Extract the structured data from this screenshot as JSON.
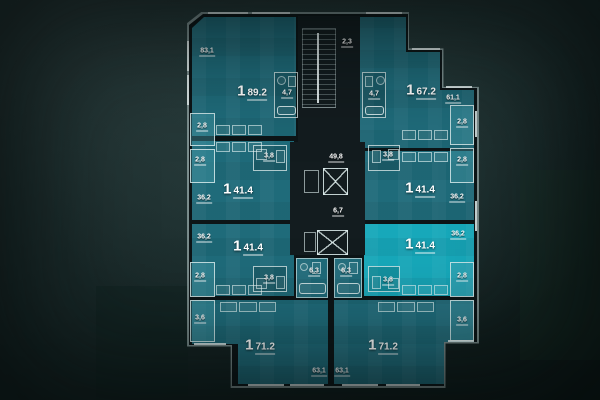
{
  "plan": {
    "apartments": [
      {
        "pos": "top-left",
        "rooms": "1",
        "area": "89.2",
        "living_area": "83,1",
        "bath_area": "4,7",
        "balcony_area": "2,8",
        "highlighted": false
      },
      {
        "pos": "top-right",
        "rooms": "1",
        "area": "67.2",
        "living_area": "61,1",
        "bath_area": "4,7",
        "balcony_area": "2,8",
        "highlighted": false
      },
      {
        "pos": "middle-upper-left",
        "rooms": "1",
        "area": "41.4",
        "living_area": "36,2",
        "bath_area": "3,8",
        "balcony_area": "2,8",
        "highlighted": false
      },
      {
        "pos": "middle-upper-right",
        "rooms": "1",
        "area": "41.4",
        "living_area": "36,2",
        "bath_area": "3,8",
        "balcony_area": "2,8",
        "highlighted": false
      },
      {
        "pos": "middle-lower-left",
        "rooms": "1",
        "area": "41.4",
        "living_area": "36,2",
        "bath_area": "3,8",
        "balcony_area": "2,8",
        "highlighted": false
      },
      {
        "pos": "middle-lower-right",
        "rooms": "1",
        "area": "41.4",
        "living_area": "36,2",
        "bath_area": "3,8",
        "balcony_area": "2,8",
        "highlighted": true
      },
      {
        "pos": "bottom-left",
        "rooms": "1",
        "area": "71.2",
        "living_area": "63,1",
        "bath_area": "6,3",
        "balcony_area": "3,6",
        "highlighted": false
      },
      {
        "pos": "bottom-right",
        "rooms": "1",
        "area": "71.2",
        "living_area": "63,1",
        "bath_area": "6,3",
        "balcony_area": "3,6",
        "highlighted": false
      }
    ],
    "core": {
      "stairwell_area": "2,3",
      "corridor_area": "49,8",
      "elevator_lobby_area": "6,7"
    },
    "colors": {
      "apartment_fill": "#1f6b7a",
      "apartment_highlight": "#17a8ba",
      "core_fill": "#131c1f",
      "wall": "#0d1517",
      "outline": "#b9c9c9",
      "label": "#ffffff"
    }
  }
}
